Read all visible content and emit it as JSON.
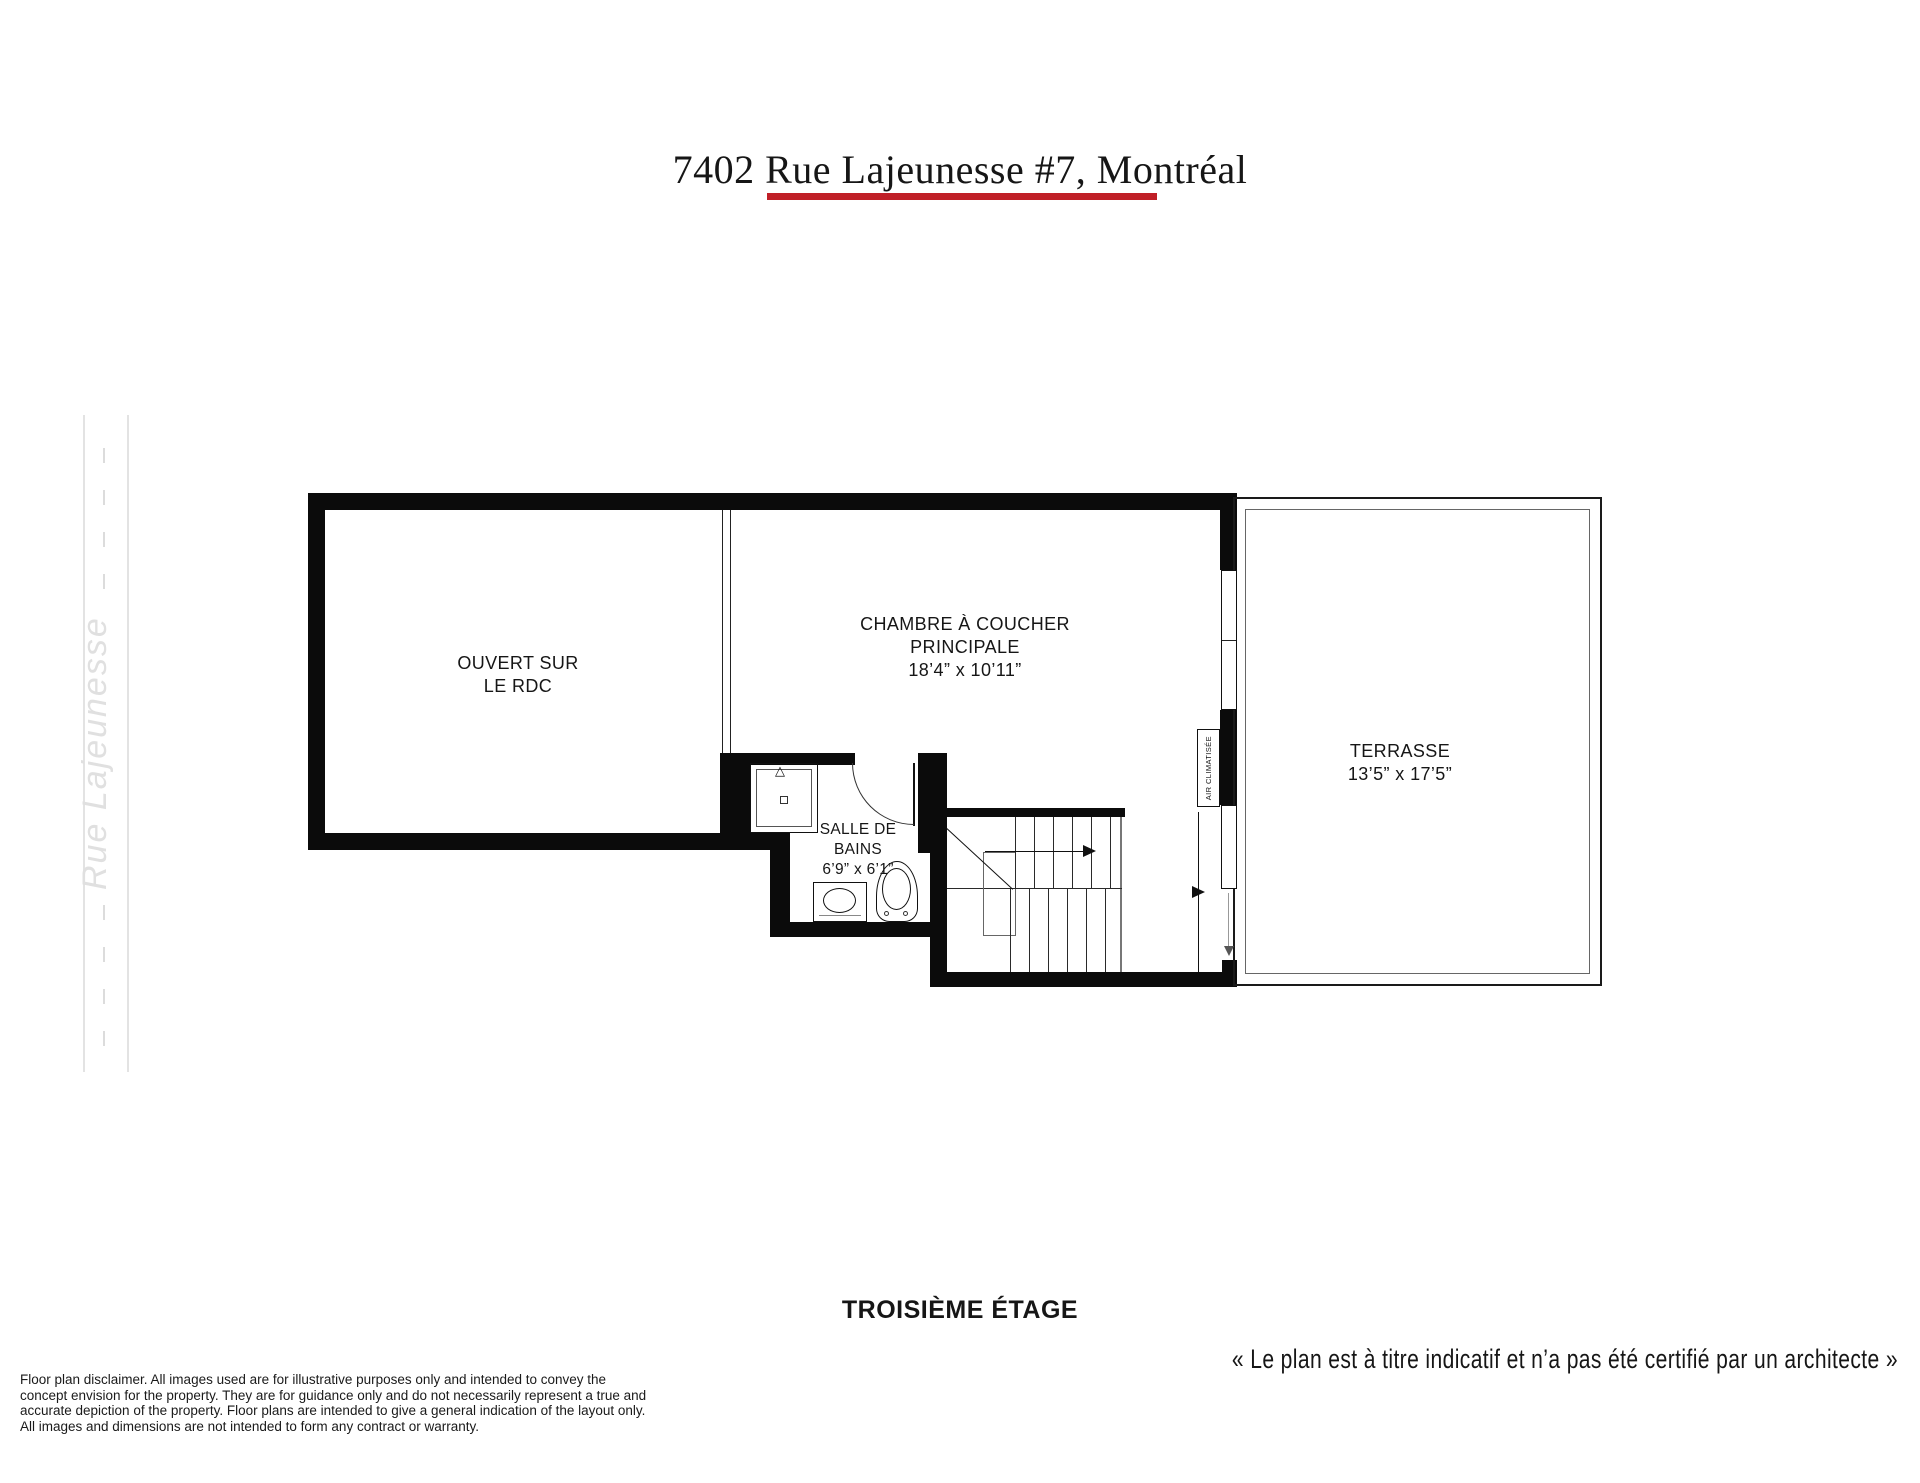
{
  "title": {
    "text": "7402 Rue Lajeunesse #7, Montréal"
  },
  "street": {
    "name": "Rue Lajeunesse"
  },
  "rooms": {
    "open_area": {
      "line1": "OUVERT SUR",
      "line2": "LE RDC"
    },
    "bedroom": {
      "line1": "CHAMBRE À COUCHER",
      "line2": "PRINCIPALE",
      "dims": "18’4” x 10’11”"
    },
    "bathroom": {
      "line1": "SALLE DE",
      "line2": "BAINS",
      "dims": "6’9” x 6’1”"
    },
    "terrace": {
      "line1": "TERRASSE",
      "dims": "13’5” x 17’5”"
    },
    "ac_unit": {
      "label": "AIR CLIMATISÉE"
    }
  },
  "footer": {
    "floor_label": "TROISIÈME ÉTAGE",
    "quote": "« Le plan est à titre indicatif et n’a pas été certifié par un architecte »"
  },
  "disclaimer": {
    "lines": [
      "Floor plan disclaimer. All images used are for illustrative purposes only and intended to convey the",
      "concept envision for the property. They are for guidance only and do not necessarily represent a true and",
      "accurate depiction of the property. Floor plans are intended to give a general indication of the layout only.",
      "All images and dimensions are not intended to form any contract or warranty."
    ]
  },
  "colors": {
    "wall": "#0b0b0b",
    "accent_red": "#c01f27",
    "road_gray": "#e3e3e3"
  }
}
